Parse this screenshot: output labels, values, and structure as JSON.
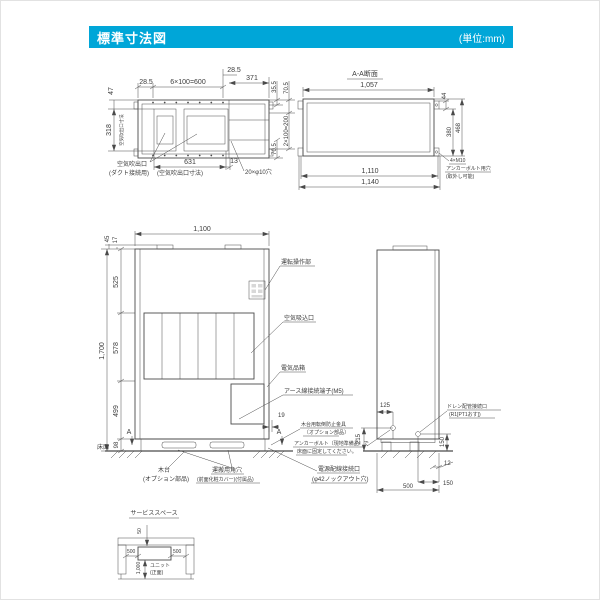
{
  "header": {
    "title": "標準寸法図",
    "unit_note": "(単位:mm)"
  },
  "colors": {
    "accent": "#00a6d8",
    "line": "#4a4a4a"
  },
  "top_view": {
    "d47": "47",
    "d285_left": "28.5",
    "d600": "6×100=600",
    "d285_right": "28.5",
    "d371": "371",
    "d355": "35.5",
    "d705_top": "70.5",
    "d318": "318",
    "outlet_dim_vertical": "空気吹出口寸法",
    "d631": "631",
    "d13": "13",
    "holes": "20×φ10穴",
    "d705_bottom": "70.5",
    "d200": "2×100=200",
    "outlet_label": "空気吹出口",
    "outlet_sub": "(ダクト接続用)",
    "outlet_dim_label": "(空気吹出口寸法)"
  },
  "section_view": {
    "title": "A-A断面",
    "d1057": "1,057",
    "d44": "44",
    "d380": "380",
    "d468": "468",
    "d1110": "1,110",
    "d1140": "1,140",
    "note1": "4×M10",
    "note2": "アンカーボルト用穴",
    "note3": "(取外し可能)"
  },
  "front_view": {
    "d1100": "1,100",
    "d45": "45",
    "d17": "17",
    "d525": "525",
    "d578": "578",
    "d499": "499",
    "d98": "98",
    "d1700": "1,700",
    "d19": "19",
    "label_operation": "運転操作部",
    "label_intake": "空気吸込口",
    "label_elec_box": "電気品箱",
    "label_earth": "アース線接続端子(M5)",
    "section_mark": "A",
    "label_floor": "床面",
    "label_base": "木台",
    "label_base_sub": "(オプション部品)",
    "label_hole": "運搬用角穴",
    "label_hole_sub": "(前面化粧カバー)(付属品)",
    "label_power": "電源配線接続口",
    "label_power_sub": "(φ42ノックアウト穴)"
  },
  "side_view": {
    "d125": "125",
    "d215": "215",
    "d150_right": "150",
    "d12": "12",
    "d150_bottom": "150",
    "d500": "500",
    "label_drain": "ドレン配管接続口",
    "label_drain_sub": "(R1[PT1おす])",
    "note_bracket1": "木台用転倒防止金具",
    "note_bracket2": "〔オプション部品〕",
    "note_anchor1": "アンカーボルト〔現地準備品〕で",
    "note_anchor2": "床面に固定してください。"
  },
  "service_space": {
    "title": "サービススペース",
    "d50": "50",
    "d500_left": "500",
    "d500_right": "500",
    "d1000": "1,000",
    "label_unit": "ユニット",
    "label_unit_sub": "(正面)"
  }
}
